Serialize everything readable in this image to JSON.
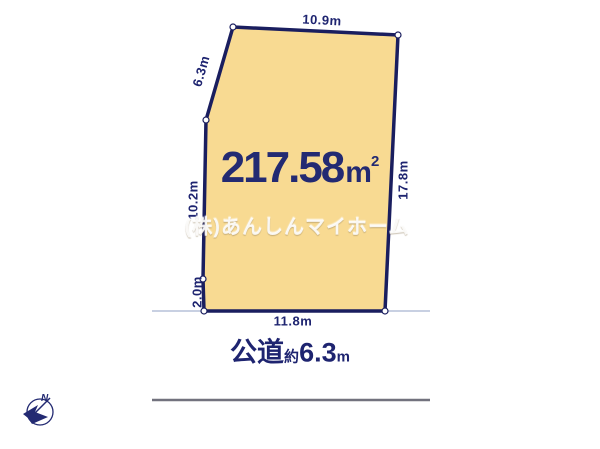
{
  "plot": {
    "area_value": "217.58",
    "area_unit": "m",
    "area_sup": "2",
    "watermark": "(株)あんしんマイホーム",
    "dimensions": {
      "top": "10.9m",
      "upper_left": "6.3m",
      "left": "10.2m",
      "lower_left": "2.0m",
      "right": "17.8m",
      "bottom": "11.8m"
    }
  },
  "road": {
    "type_label": "公道",
    "approx_label": "約",
    "width_value": "6.3",
    "width_unit": "m"
  },
  "compass": {
    "north_label": "N"
  },
  "colors": {
    "plot_fill": "#F8DA92",
    "plot_border": "#1A1E5F",
    "dimension_text": "#1E2470",
    "area_text": "#232A72",
    "watermark_text": "#FFFFFF",
    "ground_line": "#B6C0D8",
    "road_line": "#72727E"
  }
}
